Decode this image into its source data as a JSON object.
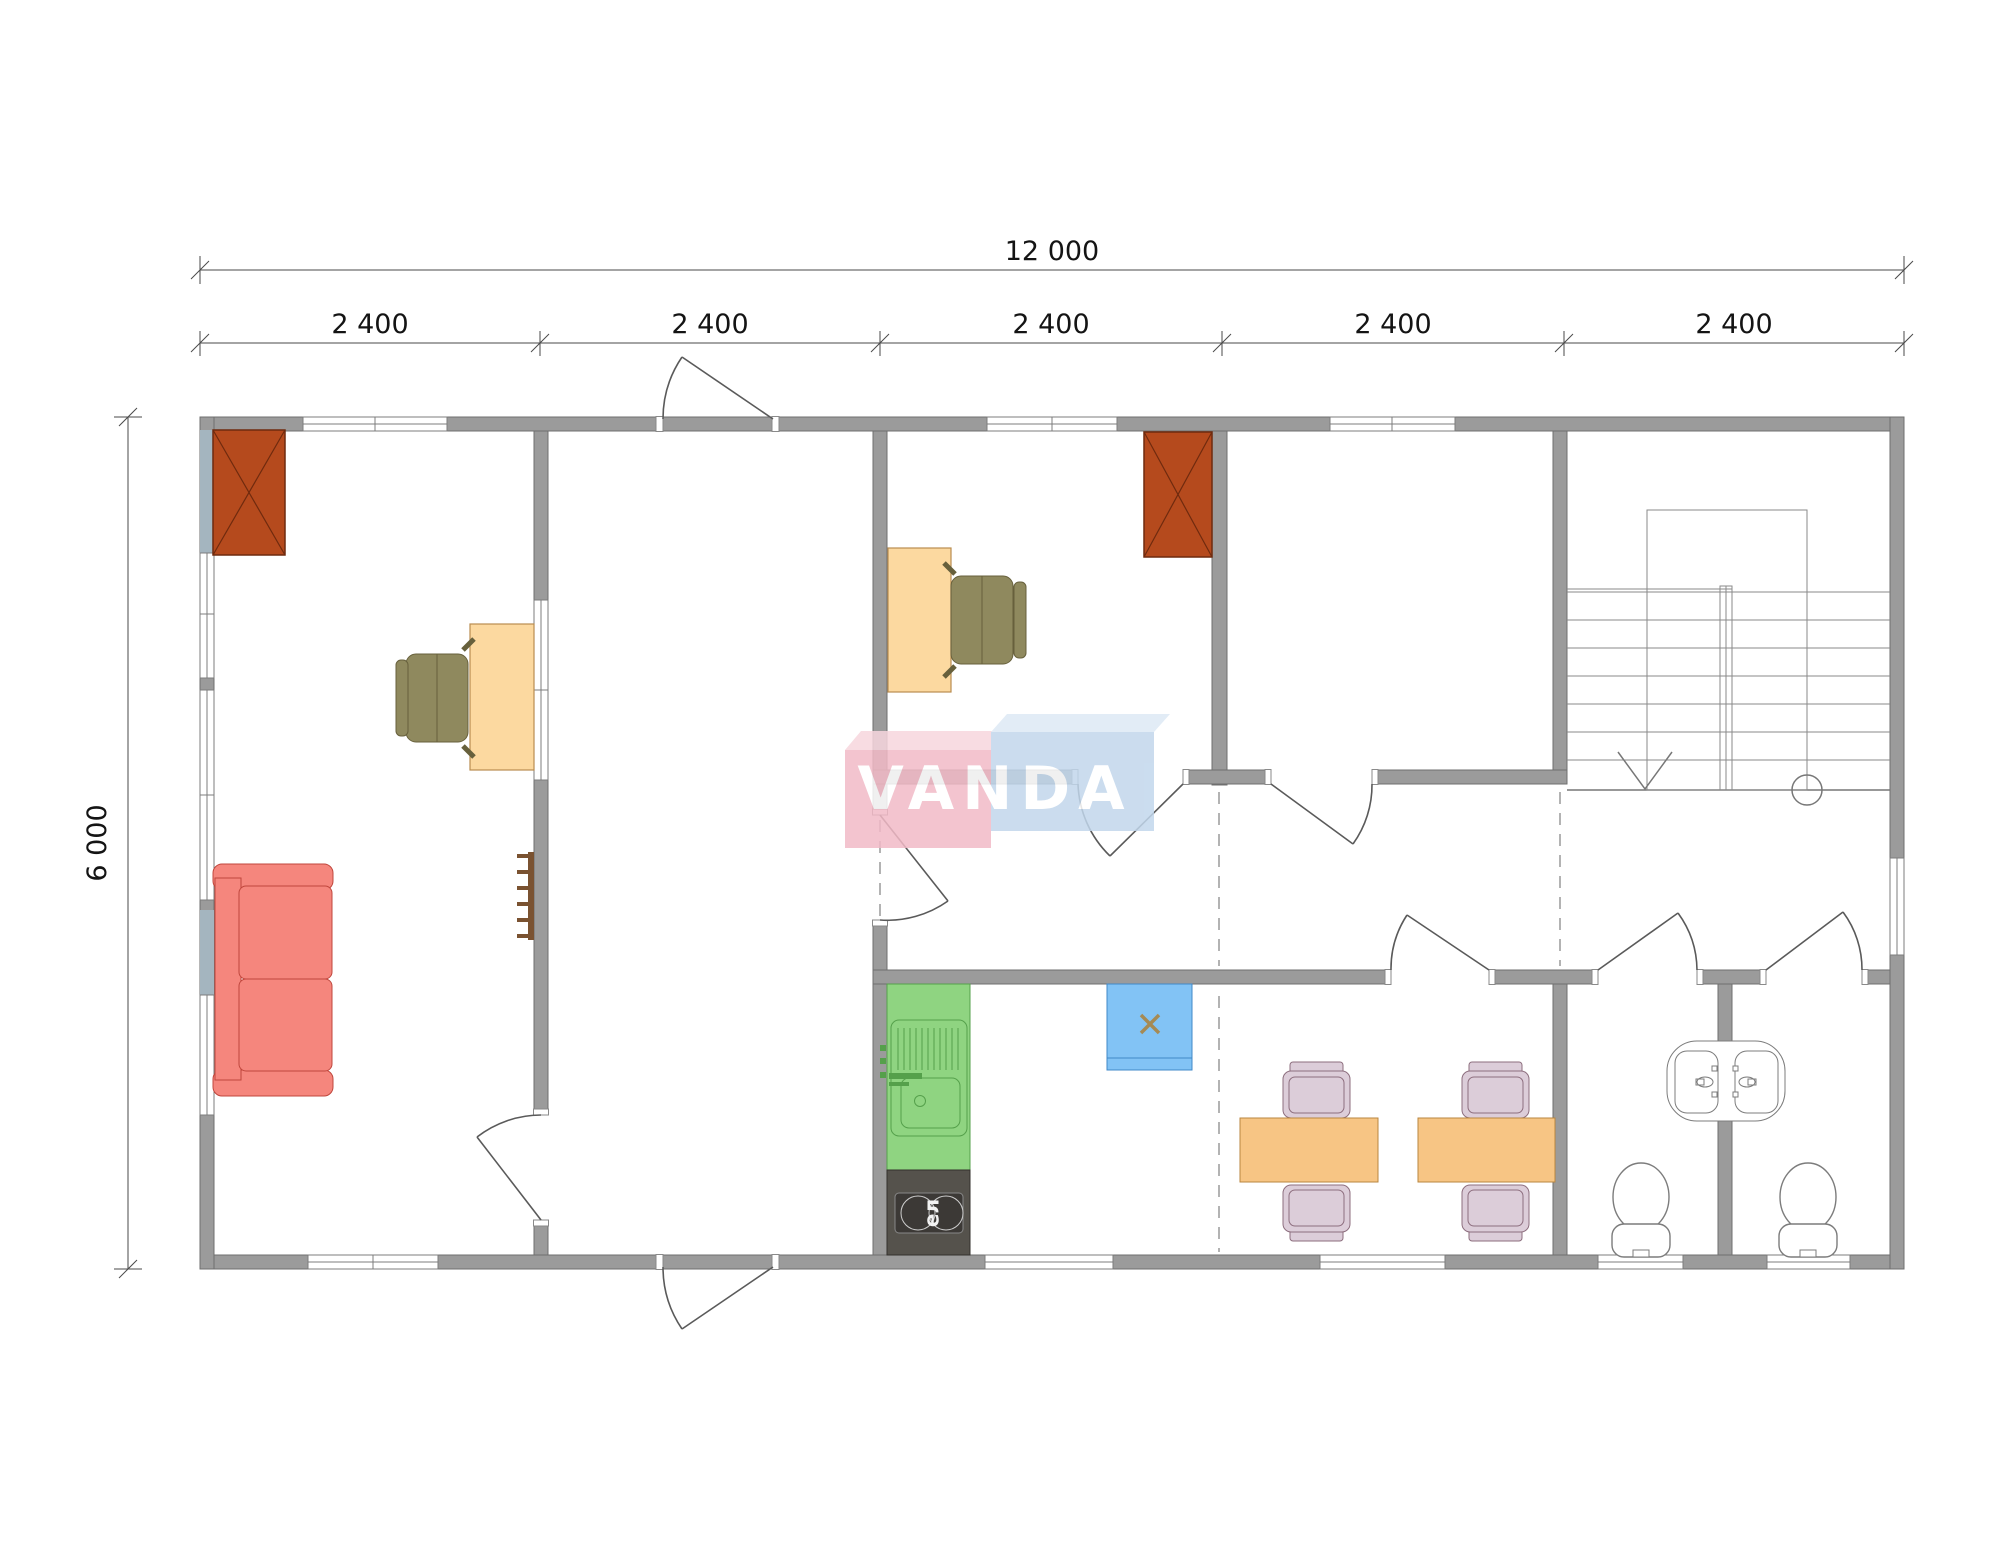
{
  "dims": {
    "total": "12 000",
    "height": "6 000",
    "segments": [
      "2 400",
      "2 400",
      "2 400",
      "2 400",
      "2 400"
    ]
  },
  "labels": {
    "stove": "ел"
  },
  "watermark": {
    "text": "VANDA"
  },
  "colors": {
    "wall": "#9b9b9b",
    "glass_pier": "#a4b5bf",
    "fireplace": "#b54a1d",
    "fireplace_stroke": "#6f2a0e",
    "desk": "#fcd9a0",
    "desk_stroke": "#b98d4f",
    "office_chair": "#8f895e",
    "office_chair_stroke": "#67603c",
    "sofa": "#f5867d",
    "sofa_stroke": "#c0473d",
    "rack": "#7a5231",
    "counter": "#8fd481",
    "counter_stroke": "#55a04b",
    "stove_body": "#55524c",
    "stove_panel": "#3c3936",
    "heater": "#82c3f5",
    "heater_stroke": "#4088c8",
    "heater_x": "#a58a55",
    "table": "#f7c584",
    "table_stroke": "#b9863f",
    "chair": "#dccdd9",
    "chair_stroke": "#8d6e7e",
    "logo_pink": "#f2bac7",
    "logo_pink_top": "#f7d6de",
    "logo_blue": "#c2d7ec",
    "logo_blue_top": "#dde9f5",
    "logo_text": "#ffffff"
  }
}
